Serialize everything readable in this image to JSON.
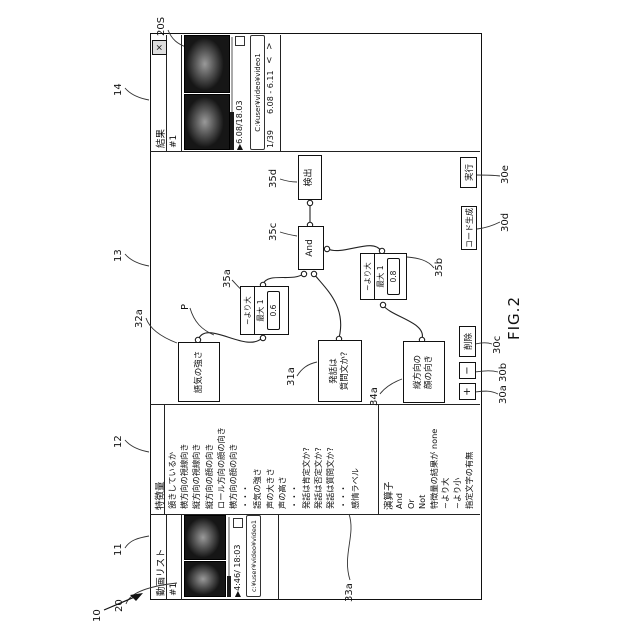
{
  "figure": {
    "caption": "FIG.2"
  },
  "refs": {
    "r10": "10",
    "r11": "11",
    "r12": "12",
    "r13": "13",
    "r14": "14",
    "r20": "20",
    "r20S": "20S",
    "r30a": "30a",
    "r30b": "30b",
    "r30c": "30c",
    "r30d": "30d",
    "r30e": "30e",
    "r31a": "31a",
    "r32a": "32a",
    "r33a": "33a",
    "r34a": "34a",
    "r35a": "35a",
    "r35b": "35b",
    "r35c": "35c",
    "r35d": "35d",
    "rP": "P"
  },
  "video_list": {
    "title": "動画リスト",
    "item_id": "#1",
    "player_time": "▶4:46/ 18:03",
    "path": "c:¥user¥video¥video1"
  },
  "features": {
    "title": "特徴量",
    "items": [
      "頷きしているか",
      "横方向の視線向き",
      "縦方向の視線向き",
      "縦方向の顔の向き",
      "ロール方向の顔の向き",
      "横方向の顔の向き",
      "・・・",
      "語気の強さ",
      "声の大きさ",
      "声の高さ",
      "・・・",
      "発話は肯定文か?",
      "発話は否定文か?",
      "発話は質問文か?",
      "・・・",
      "感情ラベル"
    ]
  },
  "operators": {
    "title": "演算子",
    "items": [
      "And",
      "Or",
      "Not",
      "特徴量の結果が none",
      "~より大",
      "~より小",
      "指定文字の有無"
    ]
  },
  "canvas": {
    "nodes": {
      "tone": {
        "label": "語気の強さ"
      },
      "question": {
        "label_line1": "発話は",
        "label_line2": "質問文か?"
      },
      "face": {
        "label_line1": "縦方向の",
        "label_line2": "顔の向き"
      },
      "gt1": {
        "op": "~より大",
        "max": "最大 1",
        "value": "0.6"
      },
      "gt2": {
        "op": "~より大",
        "max": "最大 1",
        "value": "0.8"
      },
      "and": {
        "label": "And"
      },
      "detect": {
        "label": "検出"
      }
    },
    "toolbar": {
      "add": "+",
      "minus": "−",
      "delete": "削除",
      "codegen": "コード生成",
      "run": "実行"
    }
  },
  "results": {
    "title": "結果",
    "close": "×",
    "item_id": "#1",
    "player_time": "▶6.08/18.03",
    "path": "C:¥user¥video¥video1",
    "page": "1/39",
    "range": "6.08 - 6.11",
    "prev": "<",
    "next": ">"
  }
}
